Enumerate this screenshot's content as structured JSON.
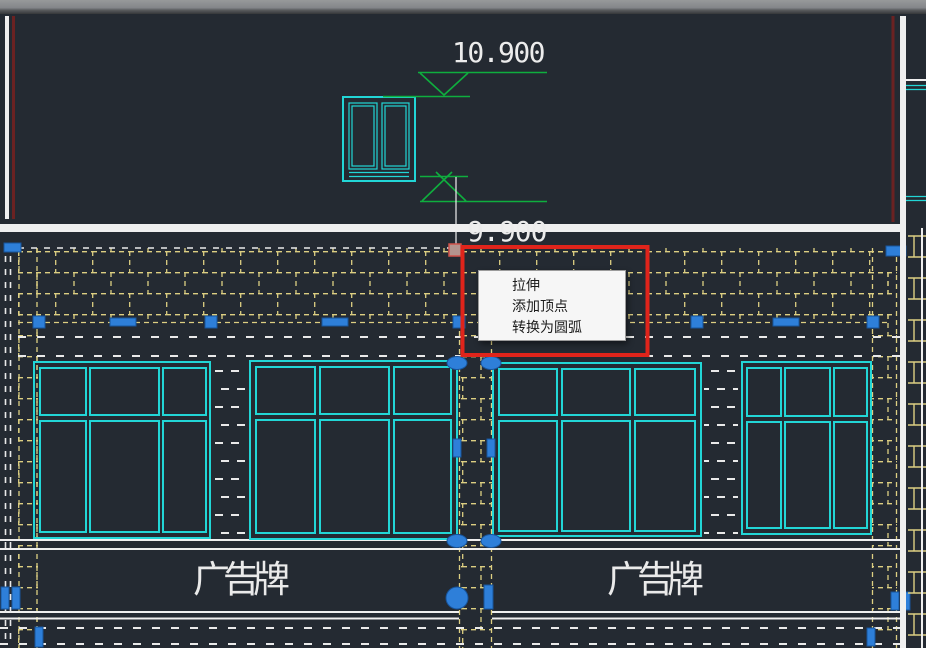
{
  "drawing": {
    "dim_upper": "10.900",
    "dim_lower": "9.900",
    "billboard_left": "广告牌",
    "billboard_right": "广告牌"
  },
  "context_menu": {
    "items": [
      {
        "label": "拉伸"
      },
      {
        "label": "添加顶点"
      },
      {
        "label": "转换为圆弧"
      }
    ]
  },
  "colors": {
    "background": "#242a32",
    "titlebar_gray": "#8d8f90",
    "hatch_yellow": "#ddcf82",
    "line_white": "#efefef",
    "window_cyan": "#22d6d6",
    "marker_green": "#0fae3e",
    "grip_blue": "#2e7fd9",
    "grip_hover": "#b3948e",
    "highlight_red": "#e0241b",
    "edge_dark_red": "#6b2222",
    "menu_background": "#f6f6f6",
    "menu_text": "#1c1c1c"
  }
}
